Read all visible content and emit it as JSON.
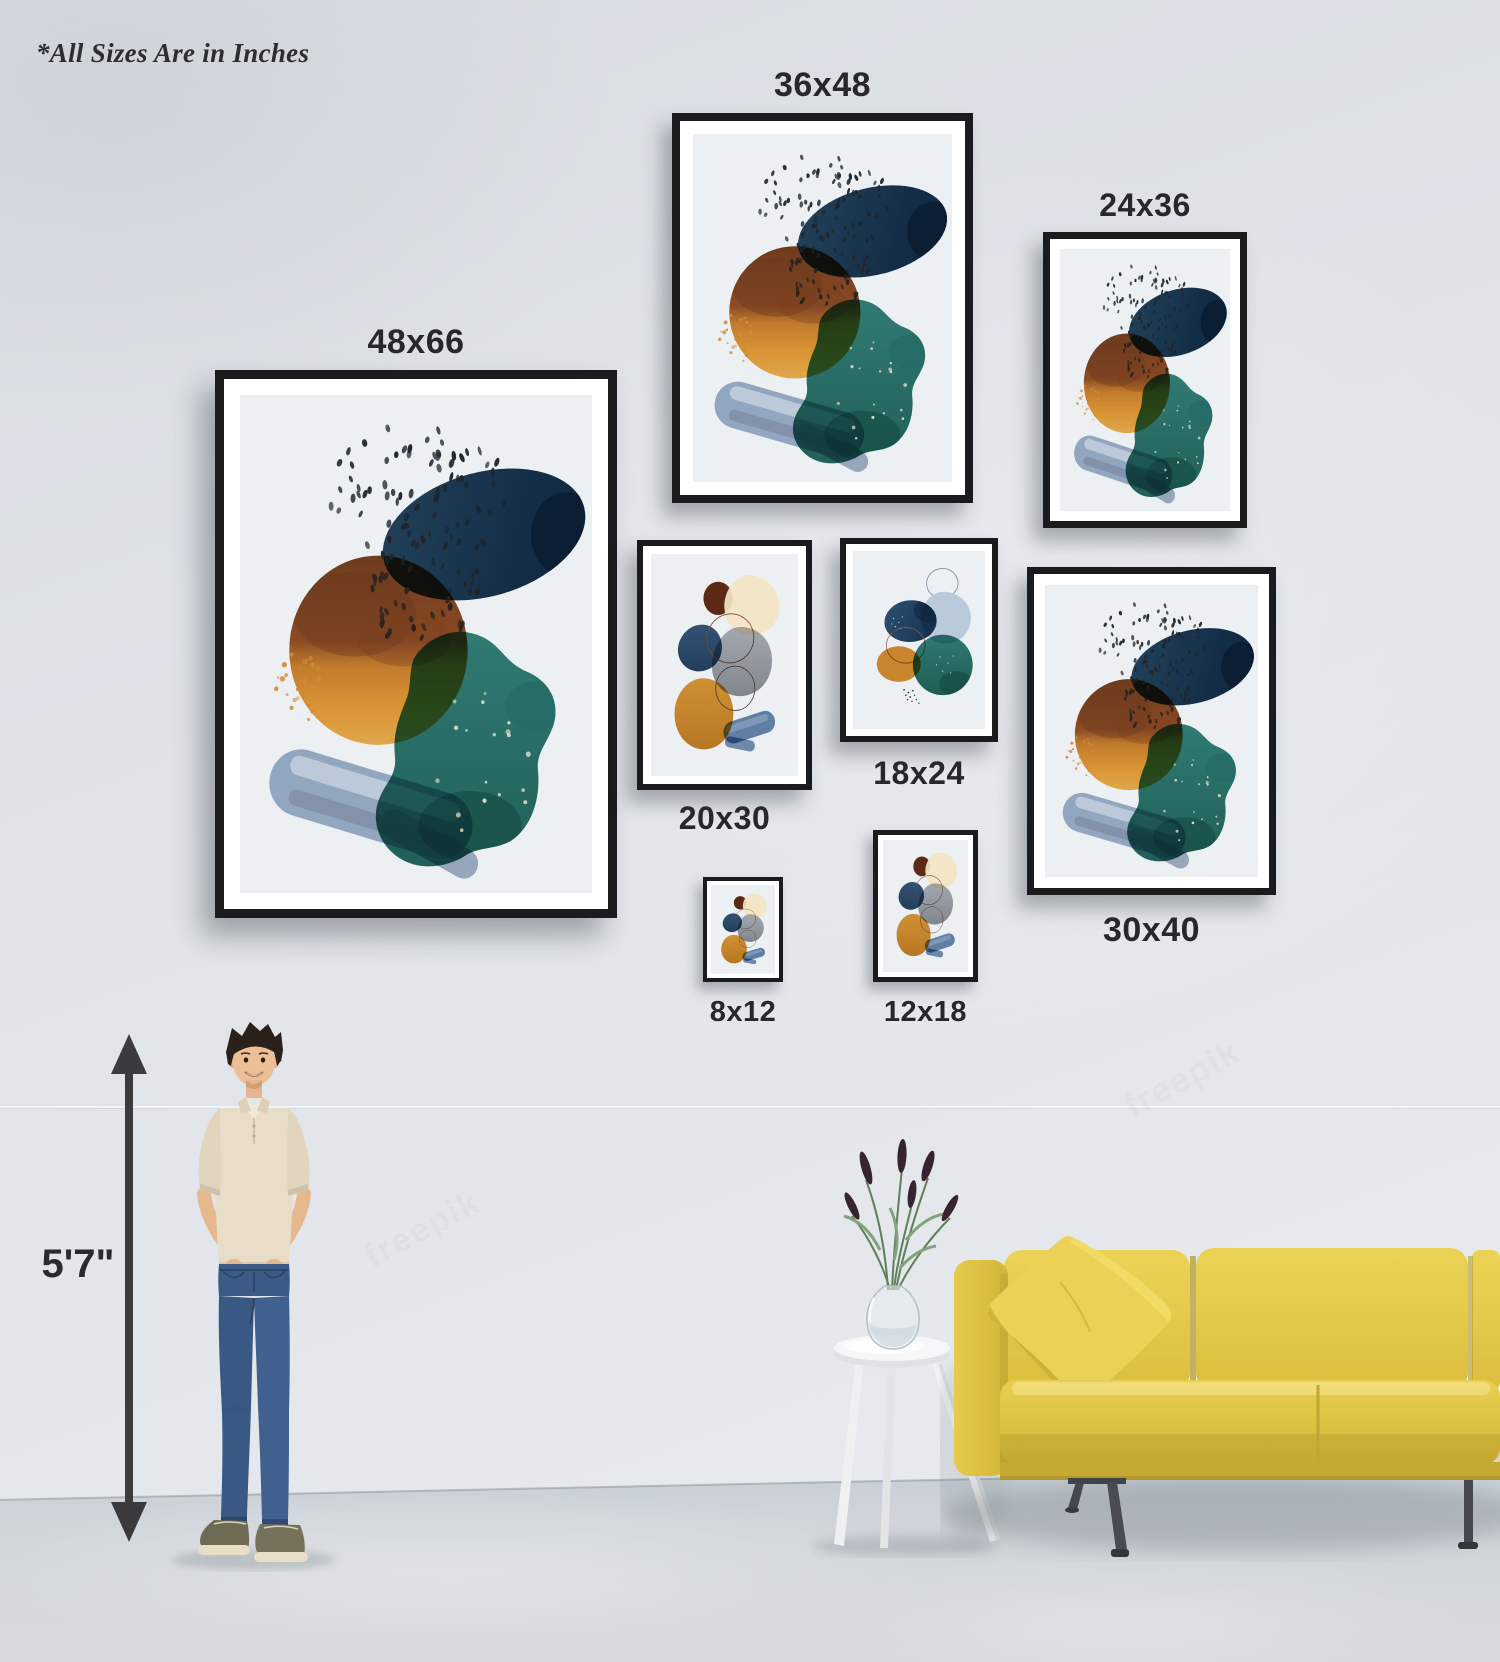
{
  "note": "*All Sizes Are in Inches",
  "height_marker": {
    "label": "5'7\""
  },
  "frames": [
    {
      "id": "36x48",
      "label": "36x48",
      "artwork": "teal-brown-navy-abstract-watercolor"
    },
    {
      "id": "24x36",
      "label": "24x36",
      "artwork": "teal-brown-navy-abstract-watercolor"
    },
    {
      "id": "48x66",
      "label": "48x66",
      "artwork": "teal-brown-navy-abstract-watercolor"
    },
    {
      "id": "20x30",
      "label": "20x30",
      "artwork": "cream-gray-orange-abstract-watercolor"
    },
    {
      "id": "18x24",
      "label": "18x24",
      "artwork": "blue-teal-orange-abstract-watercolor"
    },
    {
      "id": "30x40",
      "label": "30x40",
      "artwork": "teal-brown-navy-abstract-watercolor"
    },
    {
      "id": "8x12",
      "label": "8x12",
      "artwork": "cream-gray-orange-abstract-watercolor"
    },
    {
      "id": "12x18",
      "label": "12x18",
      "artwork": "cream-gray-orange-abstract-watercolor"
    }
  ],
  "watermark": "freepik",
  "colors": {
    "wall": "#e0e4e9",
    "floor": "#d2d7dc",
    "frame": "#1a1b1d",
    "mat": "#ffffff",
    "art_background": "#edf0f3",
    "sofa_yellow": "#e4c94b",
    "label_text": "#28282b",
    "accent_teal": "#2f7d73",
    "accent_navy": "#1e3c59",
    "accent_brown": "#8a4a24",
    "accent_orange": "#d6912f"
  }
}
